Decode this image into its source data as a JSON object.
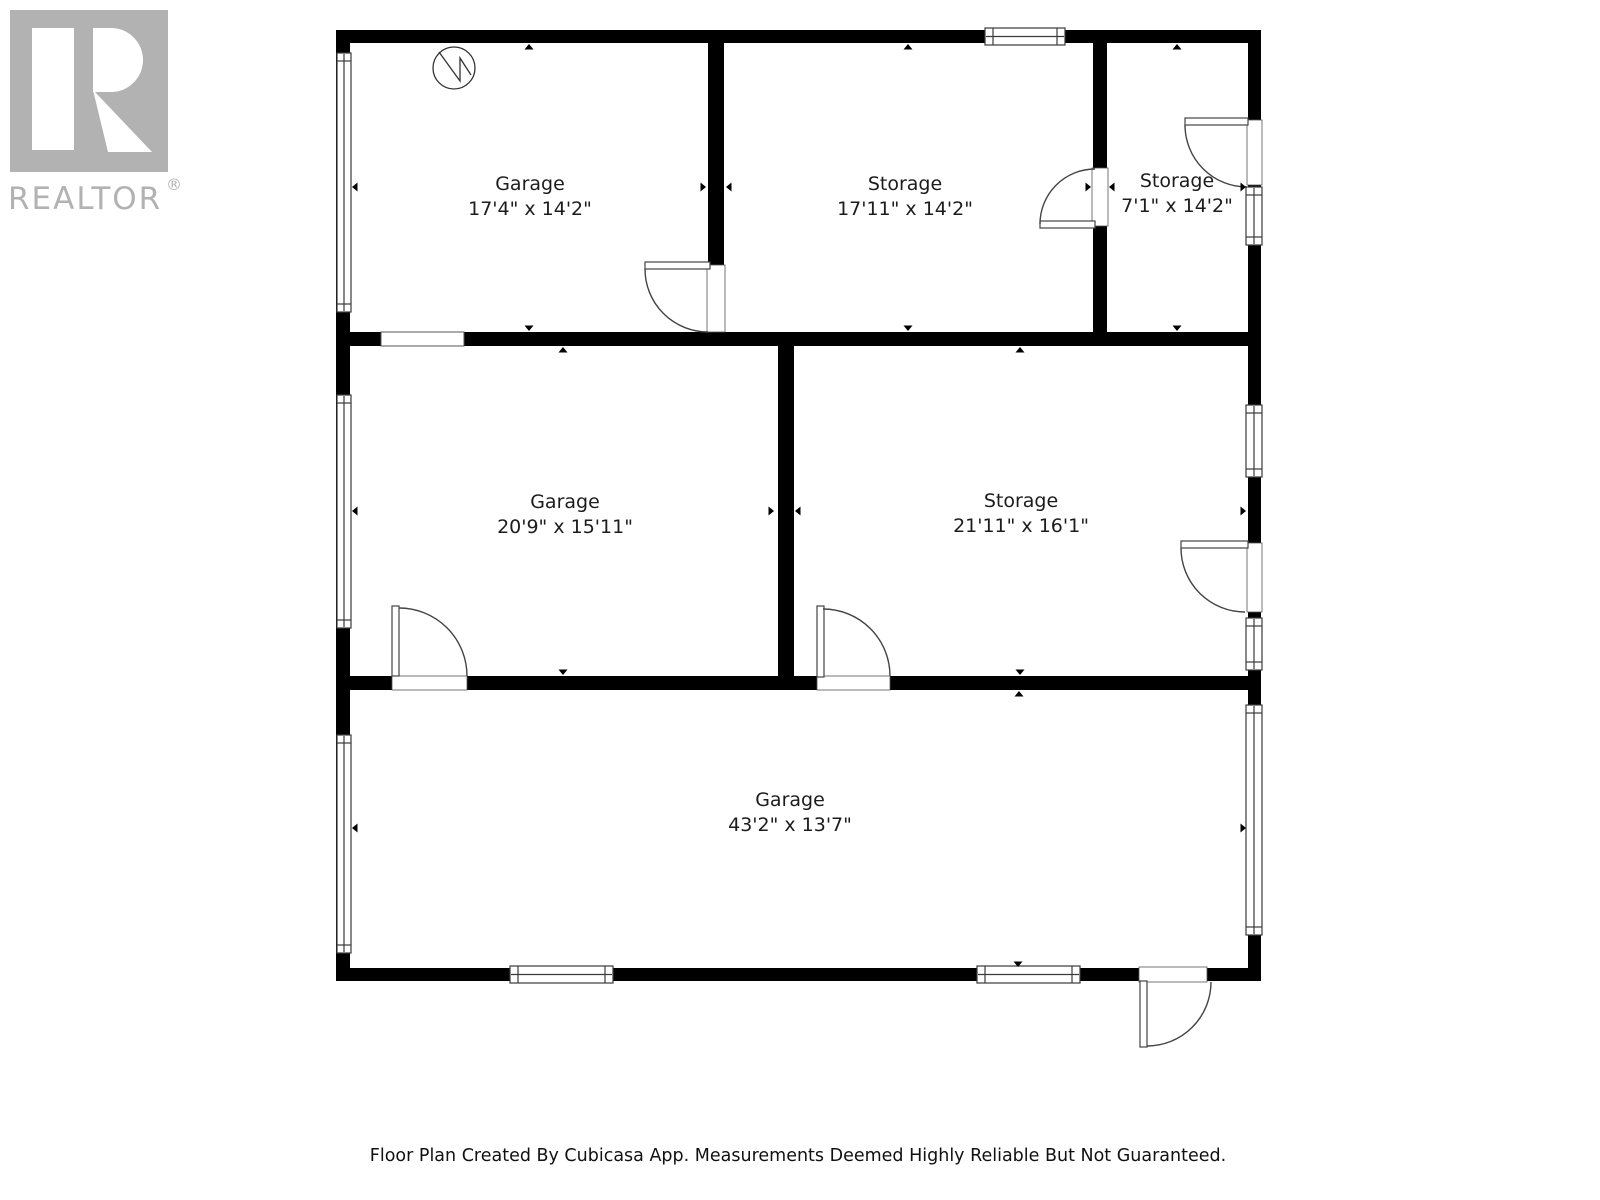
{
  "logo": {
    "text": "REALTOR",
    "registered": "®",
    "color": "#b2b2b2"
  },
  "rooms": [
    {
      "name": "Garage",
      "dims": "17'4\" x 14'2\""
    },
    {
      "name": "Storage",
      "dims": "17'11\" x 14'2\""
    },
    {
      "name": "Storage",
      "dims": "7'1\" x 14'2\""
    },
    {
      "name": "Garage",
      "dims": "20'9\" x 15'11\""
    },
    {
      "name": "Storage",
      "dims": "21'11\" x 16'1\""
    },
    {
      "name": "Garage",
      "dims": "43'2\" x 13'7\""
    }
  ],
  "footer": {
    "text": "Floor Plan Created By Cubicasa App. Measurements Deemed Highly Reliable But Not Guaranteed."
  },
  "icons": {
    "north_indicator": "north-indicator-icon",
    "realtor_logo": "realtor-logo"
  },
  "colors": {
    "wall": "#000000",
    "door_line": "#444444",
    "window_line": "#3a3a3a",
    "label_text": "#1c1c1c",
    "footer_text": "#111111",
    "logo_gray": "#b2b2b2",
    "background": "#ffffff"
  }
}
